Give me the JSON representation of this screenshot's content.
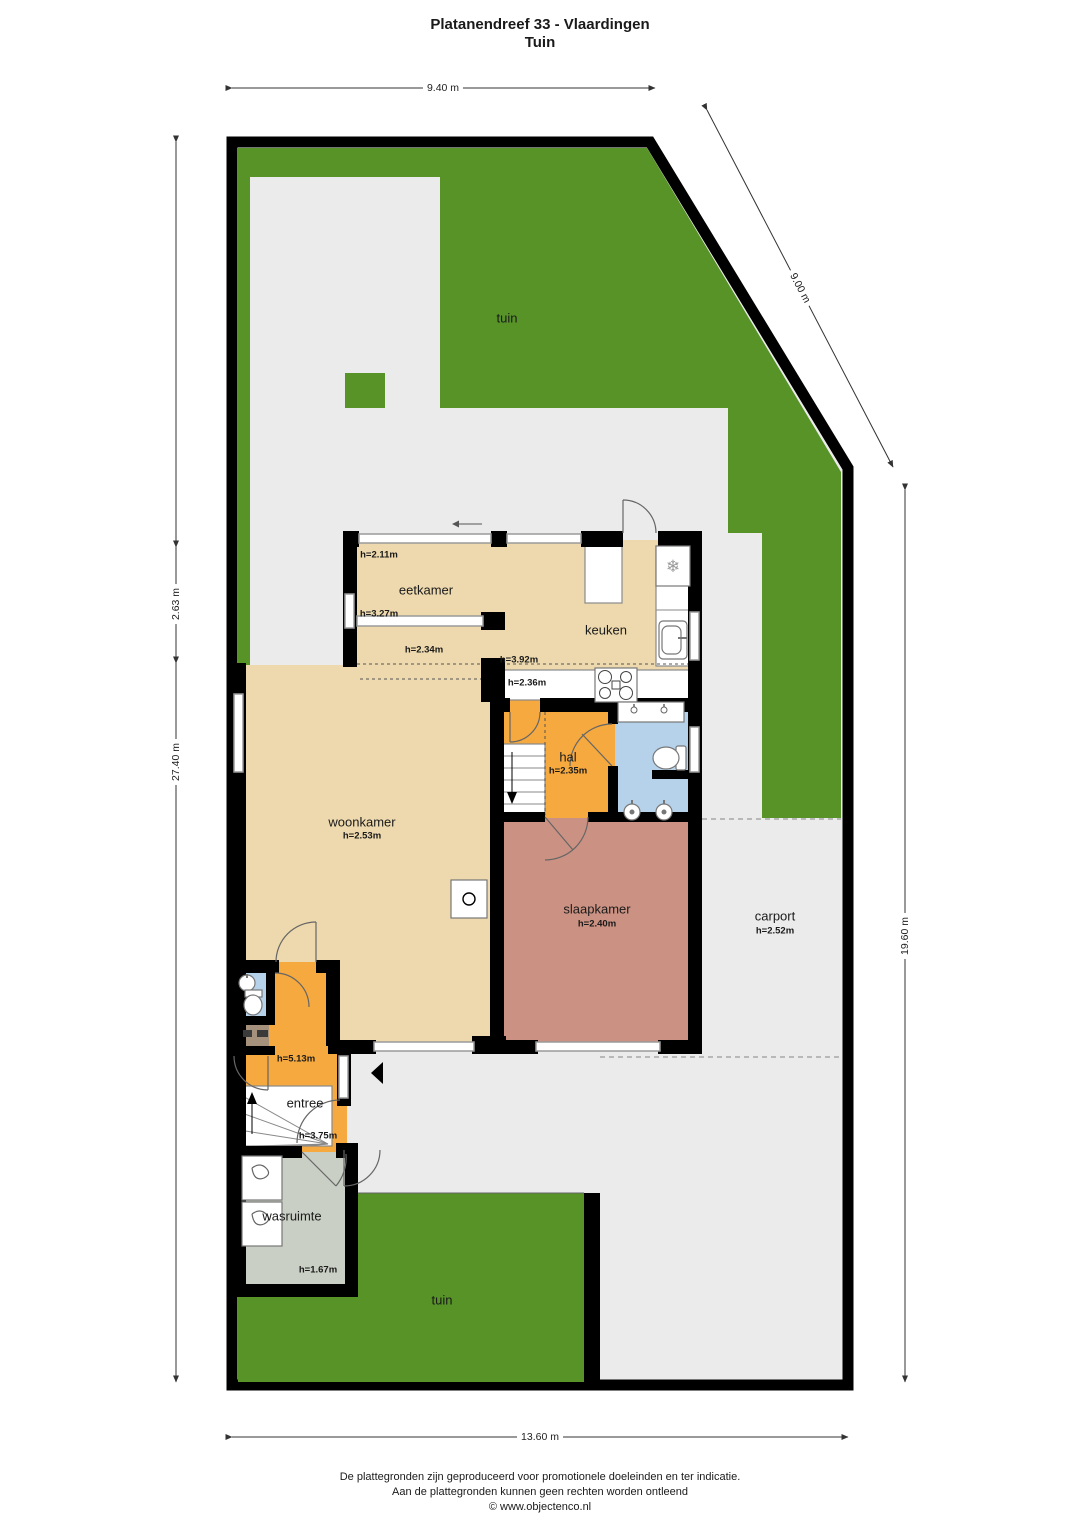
{
  "title": {
    "line1": "Platanendreef 33 - Vlaardingen",
    "line2": "Tuin"
  },
  "dimensions": {
    "top": "9.40 m",
    "diagonal": "9.00 m",
    "left_inner": "2.63 m",
    "left_outer": "27.40 m",
    "right": "19.60 m",
    "bottom": "13.60 m"
  },
  "rooms": {
    "tuin_top": {
      "name": "tuin"
    },
    "eetkamer": {
      "name": "eetkamer",
      "h1": "h=2.11m",
      "h2": "h=3.27m",
      "h3": "h=2.34m"
    },
    "keuken": {
      "name": "keuken",
      "h1": "h=3.92m",
      "h2": "h=2.36m"
    },
    "hal": {
      "name": "hal",
      "height": "h=2.35m"
    },
    "woonkamer": {
      "name": "woonkamer",
      "height": "h=2.53m"
    },
    "slaapkamer": {
      "name": "slaapkamer",
      "height": "h=2.40m"
    },
    "carport": {
      "name": "carport",
      "height": "h=2.52m"
    },
    "entree": {
      "name": "entree",
      "h1": "h=5.13m",
      "h2": "h=3.75m"
    },
    "wasruimte": {
      "name": "wasruimte",
      "height": "h=1.67m"
    },
    "tuin_bottom": {
      "name": "tuin"
    }
  },
  "icons": {
    "fridge": "❄"
  },
  "footer": {
    "line1": "De plattegronden zijn geproduceerd voor promotionele doeleinden en ter indicatie.",
    "line2": "Aan de plattegronden kunnen geen rechten worden ontleend",
    "line3": "© www.objectenco.nl"
  },
  "colors": {
    "garden": "#579327",
    "terrace": "#ebebeb",
    "living": "#edd9ad",
    "hall": "#f5a93e",
    "bedroom": "#cb9182",
    "bath": "#b5d2ea",
    "laundry": "#c9cfc4",
    "closet": "#a5917c",
    "wall": "#000000"
  }
}
